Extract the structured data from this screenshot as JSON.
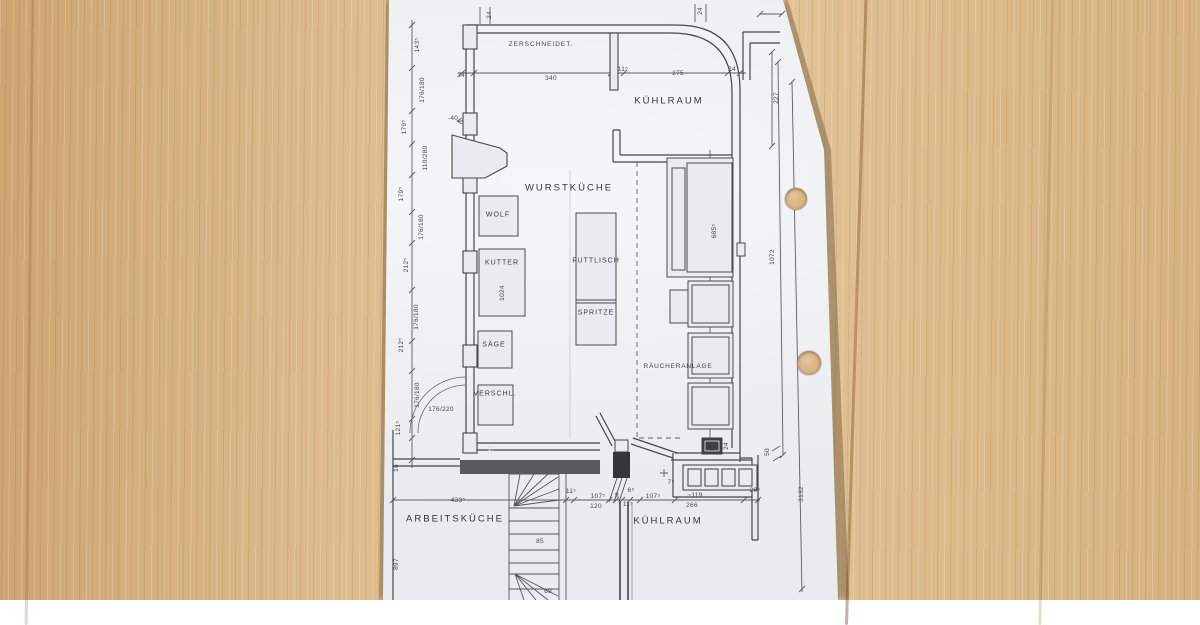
{
  "colors": {
    "paper": "#e9ebee",
    "wood": "#d7b88b",
    "ink": "#47484c"
  },
  "plan": {
    "rooms": {
      "zerschneidet": "ZERSCHNEIDET.",
      "kuehlraum_top": "KÜHLRAUM",
      "wurstkueche": "WURSTKÜCHE",
      "raeucheranlage": "RÄUCHERANLAGE",
      "arbeitskueche": "ARBEITSKÜCHE",
      "kuehlraum_bottom": "KÜHLRAUM"
    },
    "equipment": {
      "wolf": "WOLF",
      "kutter": "KUTTER",
      "kutter_capacity": "1024",
      "fuelltisch": "FUTTLISCH",
      "spritze": "SPRITZE",
      "saege": "SÄGE",
      "verschluss": "VERSCHL."
    },
    "dims_top": {
      "c24l": "24",
      "w24l": "24",
      "w340": "340",
      "w115": "11⁵",
      "w275": "275",
      "w24r": "24",
      "c24r": "24",
      "v227": "227",
      "m40": "-40"
    },
    "dims_left": [
      "143⁵",
      "176/180",
      "179⁵",
      "110/280",
      "179⁵",
      "176/180",
      "212⁵",
      "176/180",
      "212⁵",
      "176/180",
      "121⁵",
      "176/220",
      "16",
      "897",
      "433⁵"
    ],
    "dims_right": {
      "v685": "685⁵",
      "v24": "24",
      "v1072": "1072",
      "v50": "50",
      "v3132": "3132"
    },
    "dims_bottom": {
      "s11a": "11⁵",
      "s107a": "107⁵",
      "s120": "120",
      "s9": "9",
      "s6": "6⁵",
      "s11b": "11⁵",
      "s107b": "107⁵",
      "s7": "7⁵",
      "s119": "~119",
      "s266": "266",
      "s26": "26⁵",
      "s85": "85",
      "s69": "69",
      "s24": "24"
    }
  }
}
